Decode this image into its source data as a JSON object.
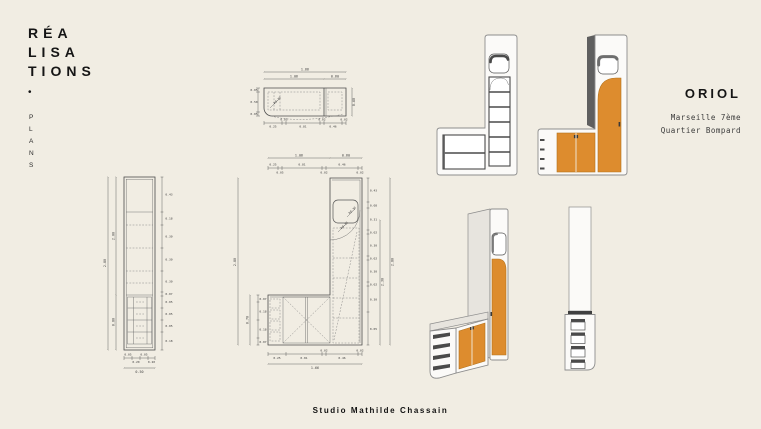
{
  "colors": {
    "background": "#f1ede3",
    "ink": "#151515",
    "muted_text": "#3a3a3a",
    "dimension_line": "#444444",
    "accent_orange": "#dd8c2e",
    "render_shadow": "#4a4a4a"
  },
  "header": {
    "title_line1": "RÉA",
    "title_line2": "LISA",
    "title_line3": "TIONS",
    "bullet": "•",
    "category_letters": [
      "P",
      "L",
      "A",
      "N",
      "S"
    ]
  },
  "project": {
    "name": "ORIOL",
    "location_line1": "Marseille 7ème",
    "location_line2": "Quartier Bompard"
  },
  "footer": {
    "studio": "Studio Mathilde Chassain"
  },
  "drawings": {
    "plan_top": {
      "total_width": "1.66",
      "left_width": "1.06",
      "right_width": "0.60",
      "depth": "0.60",
      "bottom_dims": [
        "0.25",
        "0.05",
        "0.81",
        "0.02",
        "0.46",
        "0.02"
      ],
      "left_dims": [
        "0.05",
        "0.50",
        "0.05"
      ],
      "radius": "R0.30"
    },
    "elevation_left": {
      "total_height": "2.80",
      "upper_height": "2.00",
      "lower_height": "0.80",
      "width": "0.50",
      "right_dims": [
        "0.43",
        "0.18",
        "0.30",
        "0.30",
        "0.30",
        "0.07",
        "0.05",
        "0.05",
        "0.05",
        "0.18"
      ],
      "bottom_dims": [
        "0.05",
        "0.20",
        "0.05",
        "0.20"
      ]
    },
    "elevation_l": {
      "top_left_width": "1.06",
      "top_right_width": "0.60",
      "total_width": "1.66",
      "top_dims": [
        "0.25",
        "0.05",
        "0.81",
        "0.02",
        "0.46",
        "0.02"
      ],
      "bottom_dims": [
        "0.25",
        "0.81",
        "0.02",
        "0.46",
        "0.02"
      ],
      "left_total_height": "2.80",
      "arm_height": "0.70",
      "left_arm_dims": [
        "0.07",
        "0.18",
        "0.18",
        "0.07"
      ],
      "right_inner_height": "2.30",
      "right_total_height": "2.80",
      "right_dims": [
        "0.43",
        "0.08",
        "0.31",
        "0.02",
        "0.30",
        "0.02",
        "0.30",
        "0.02",
        "0.30",
        "0.05"
      ],
      "radius_mirror": "R0.30",
      "radius_door": "R0.30"
    }
  }
}
